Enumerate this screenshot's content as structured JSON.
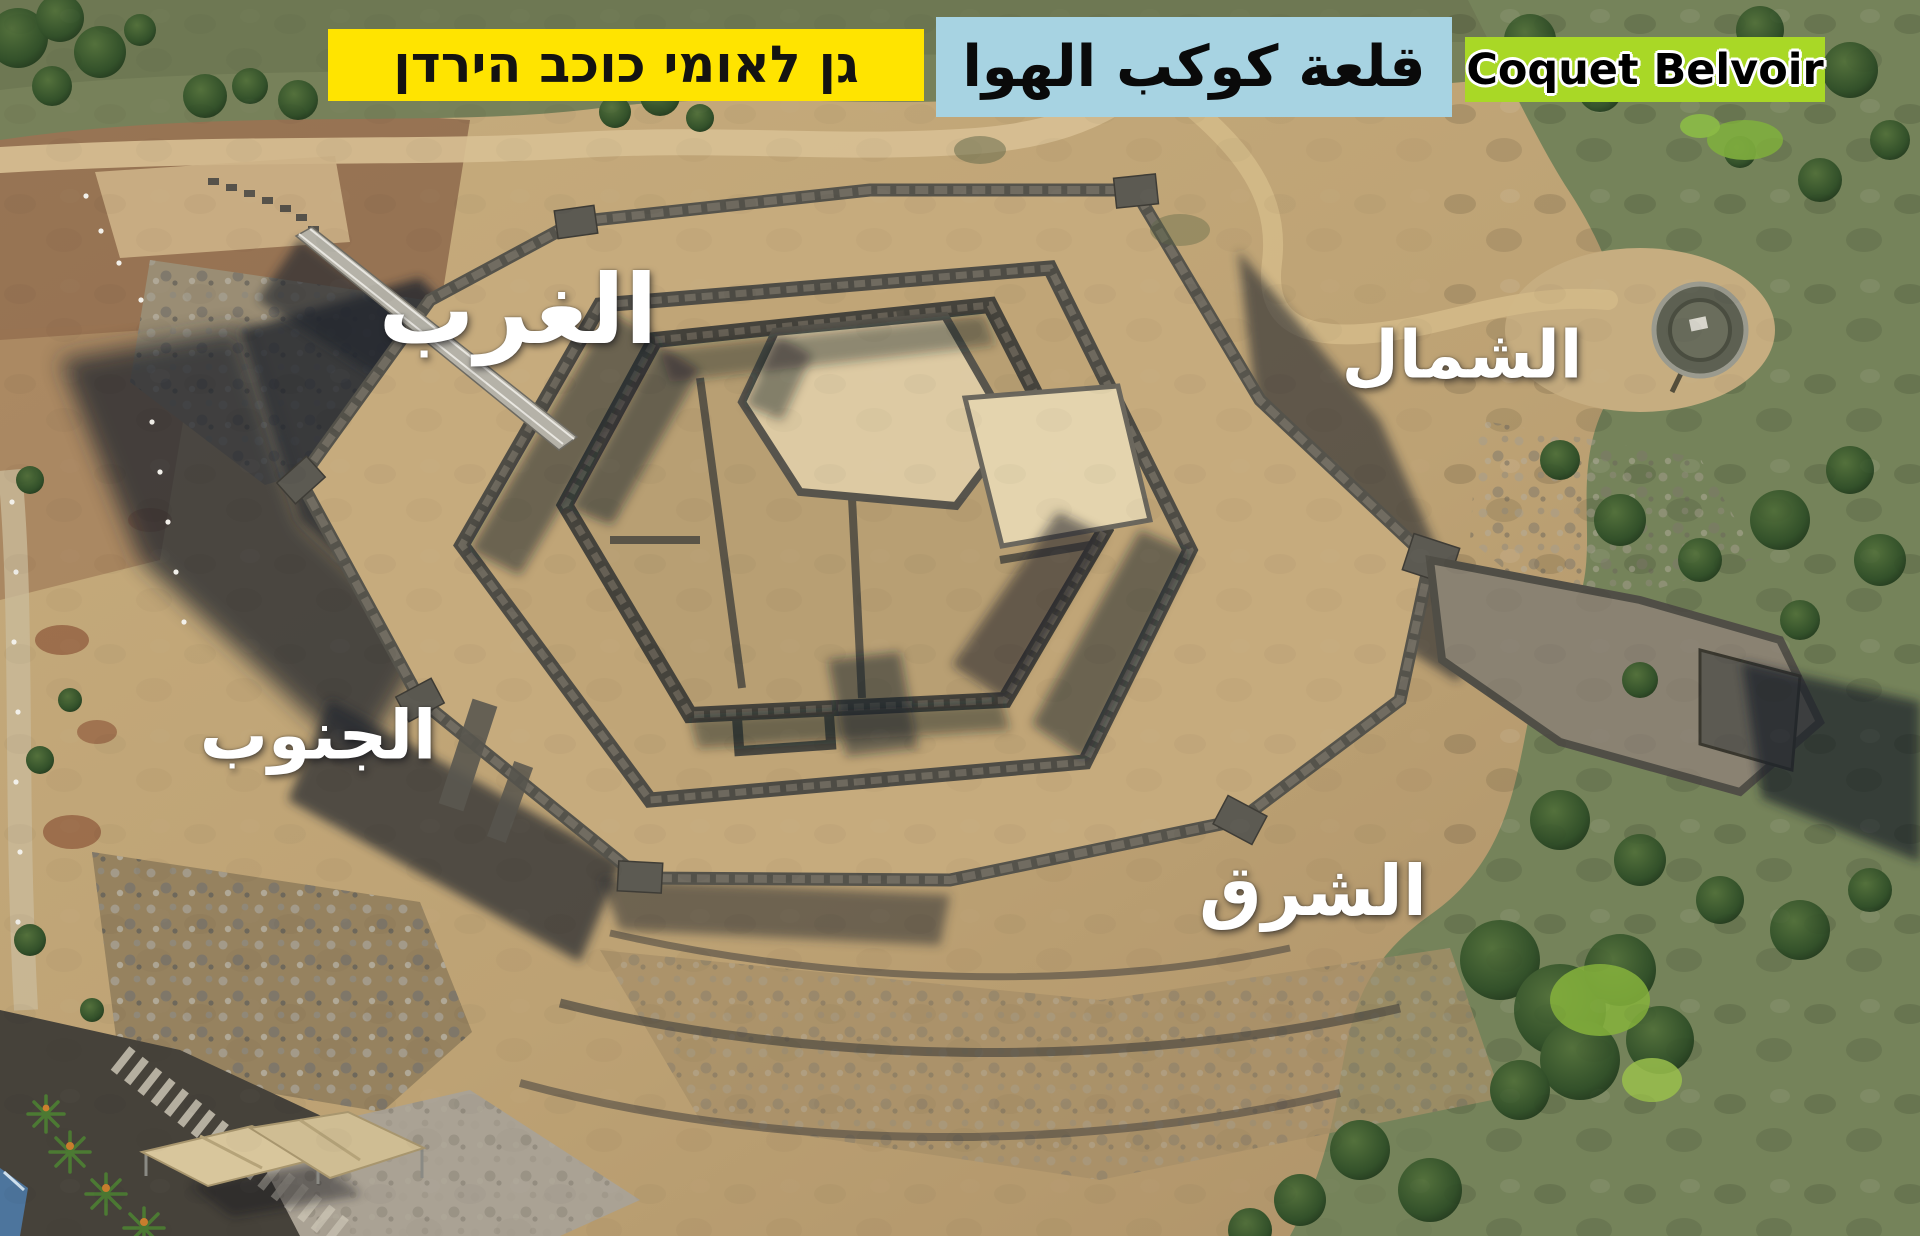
{
  "banners": {
    "national_park_hebrew": {
      "label": "גן לאומי כוכב הירדן",
      "bg_color": "#FFE400",
      "text_color": "#141311"
    },
    "fortress_arabic": {
      "label": "قلعة كوكب الهوا",
      "bg_color": "#A7D3E2",
      "text_color": "#0A0A0A"
    },
    "fortress_english": {
      "label": "Coquet Belvoir",
      "bg_color": "#A9D826",
      "text_color": "#000000"
    }
  },
  "direction_labels": {
    "west": {
      "label": "الغرب",
      "color": "#FFFFFF"
    },
    "north": {
      "label": "الشمال",
      "color": "#FFFFFF"
    },
    "south": {
      "label": "الجنوب",
      "color": "#FFFFFF"
    },
    "east": {
      "label": "الشرق",
      "color": "#FFFFFF"
    }
  },
  "photo_palette": {
    "dirt_tan": "#C3A878",
    "red_soil": "#8E684A",
    "scrub_green": "#77815A",
    "tree_green": "#2C4424",
    "basalt_wall": "#55534B",
    "limestone_courtyard": "#DDCAA3",
    "moat_shadow": "#23262D",
    "bright_bush": "#86B33C"
  }
}
